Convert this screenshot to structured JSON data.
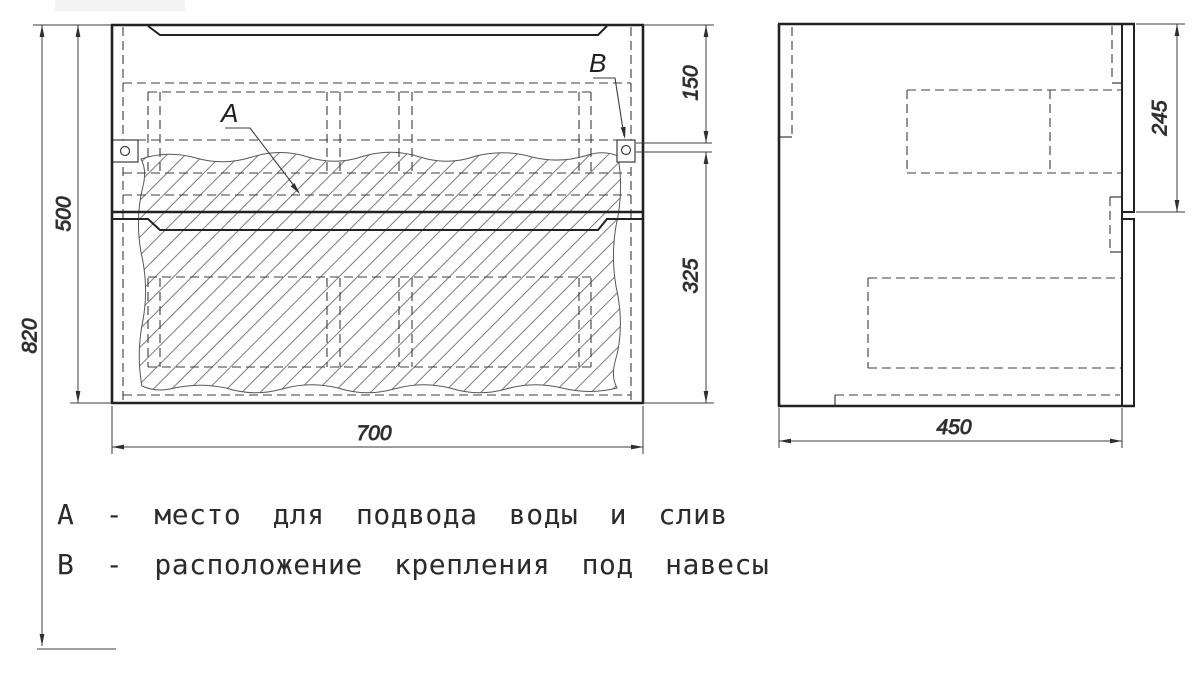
{
  "drawing": {
    "type": "furniture technical drawing, vanity cabinet with two drawers, front and side views"
  },
  "dimensions": {
    "total_height": "820",
    "cabinet_height": "500",
    "top_to_bracket": "150",
    "bracket_to_bottom": "325",
    "cabinet_width": "700",
    "drawer_front_height": "245",
    "cabinet_depth": "450"
  },
  "callouts": {
    "a": "А",
    "b": "В"
  },
  "notes": {
    "a": "А - место для подвода воды и слив",
    "b": "В - расположение крепления под навесы"
  },
  "colors": {
    "outline": "#222222",
    "thin_line": "#3d3d3d",
    "hatch": "#7d7d7d",
    "text": "#2b2b2b",
    "background": "#fefefe"
  }
}
